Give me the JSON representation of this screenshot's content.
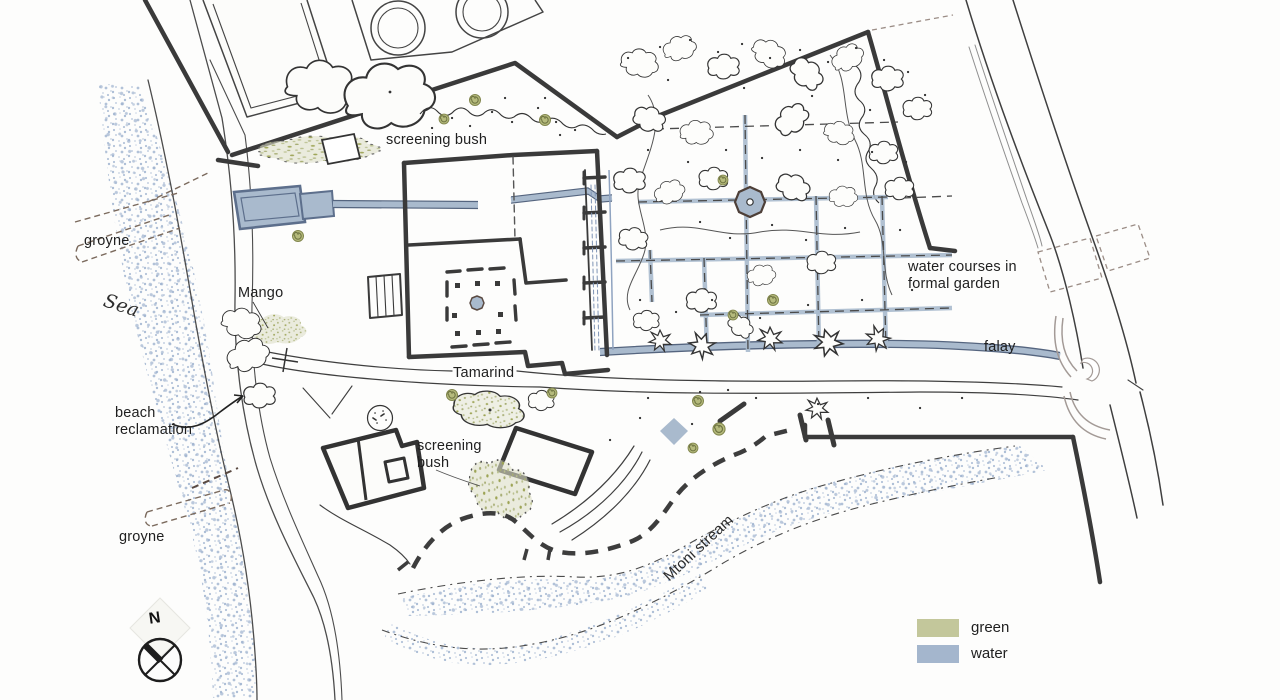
{
  "title": "Hand-drawn site plan",
  "labels": {
    "screening_bush_top": "screening bush",
    "groyne_top": "groyne",
    "sea": "Sea",
    "mango": "Mango",
    "beach_line1": "beach",
    "beach_line2": "reclamation",
    "tamarind": "Tamarind",
    "bush2_line1": "screening",
    "bush2_line2": "bush",
    "groyne_lower": "groyne",
    "wc_line1": "water courses in",
    "wc_line2": "formal garden",
    "falay": "falay",
    "mtoni_stream": "Mtoni stream",
    "north": "N"
  },
  "legend": {
    "items": [
      {
        "label": "green",
        "color": "#c3c79b"
      },
      {
        "label": "water",
        "color": "#a4b6cd"
      }
    ]
  },
  "colors": {
    "ink": "#3a3a3a",
    "water_fill": "#a9bacd",
    "water_edge": "#5d6f8c",
    "green_fill": "#c3c79b",
    "green_dark": "#8f9455",
    "sea_stipple": "#9fb3cf",
    "dash_brown": "#8a7a6e",
    "road_gray": "#a39a96"
  }
}
